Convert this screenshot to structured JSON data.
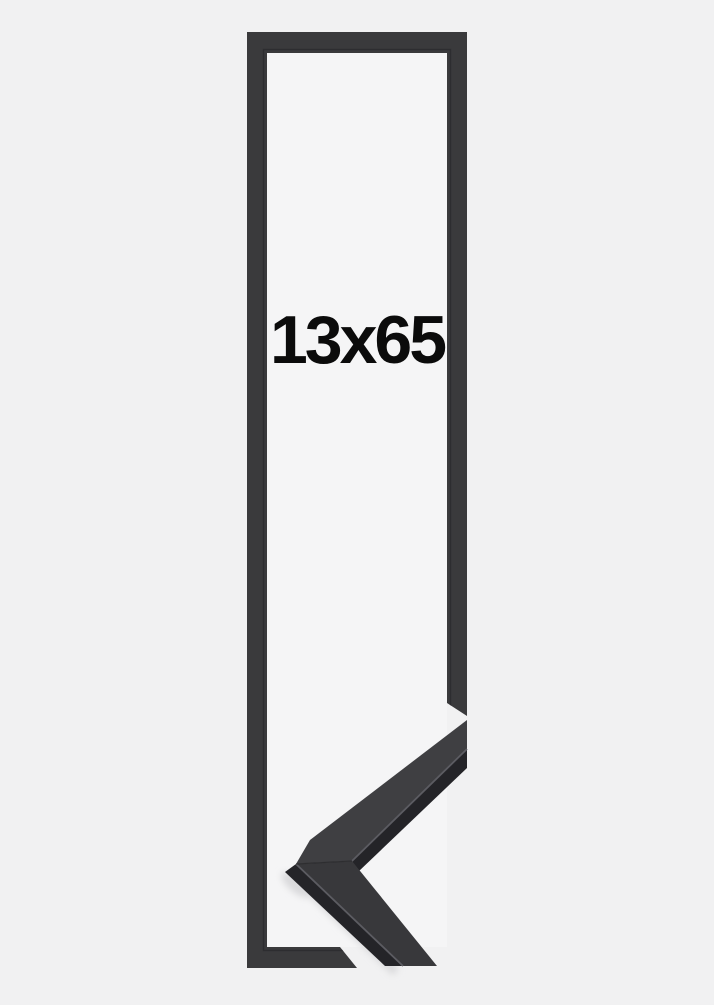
{
  "page": {
    "background_color": "#f1f1f2"
  },
  "product_image": {
    "size_label": {
      "text": "13x65",
      "color": "#0b0b0b"
    },
    "frame_outline": {
      "bar_color": "#3a3a3c",
      "lip_line_color": "#2d2d30",
      "opening_color": "#f5f5f6"
    },
    "corner_sample": {
      "top_arm_face_color": "#3f3f42",
      "bottom_arm_face_color": "#38383b",
      "side_face_color": "#242428",
      "edge_highlight_color": "#5c5c62",
      "mitre_seam_color": "#2a2a2d",
      "shadow_color": "#d9d9db"
    }
  }
}
